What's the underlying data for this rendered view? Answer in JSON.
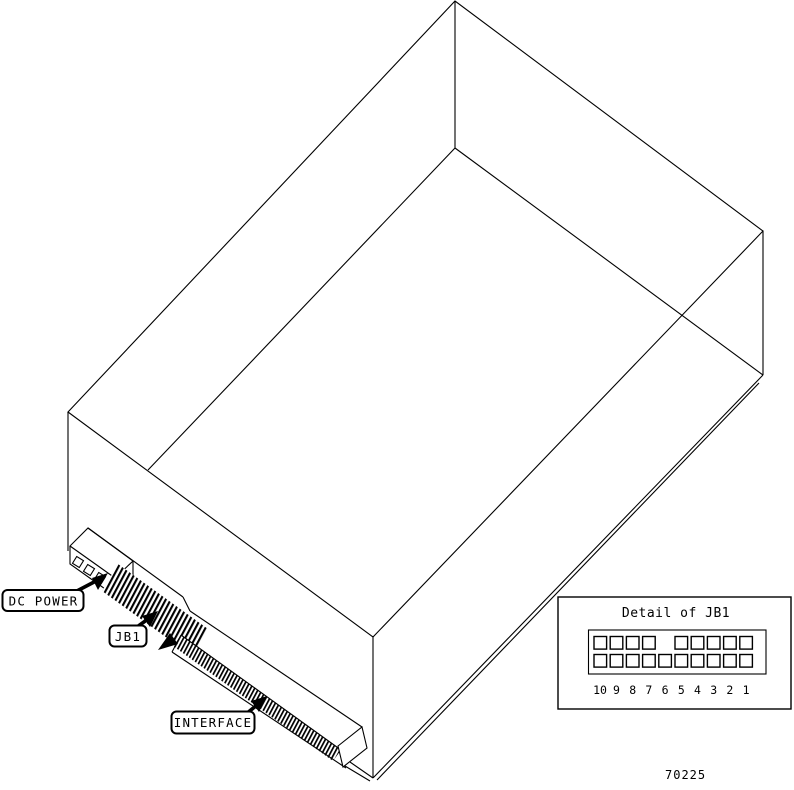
{
  "figure": {
    "callouts": {
      "dc_power": "DC POWER",
      "jb1": "JB1",
      "interface": "INTERFACE"
    },
    "detail_inset": {
      "title": "Detail of JB1",
      "pin_numbers": [
        "10",
        "9",
        "8",
        "7",
        "6",
        "5",
        "4",
        "3",
        "2",
        "1"
      ],
      "rows": 2,
      "top_row_pins_present": [
        "10",
        "9",
        "8",
        "7",
        "5",
        "4",
        "3",
        "2",
        "1"
      ],
      "bottom_row_pins_present": [
        "10",
        "9",
        "8",
        "7",
        "6",
        "5",
        "4",
        "3",
        "2",
        "1"
      ]
    },
    "figure_number": "70225",
    "colors": {
      "line": "#000000",
      "background": "#ffffff"
    }
  }
}
